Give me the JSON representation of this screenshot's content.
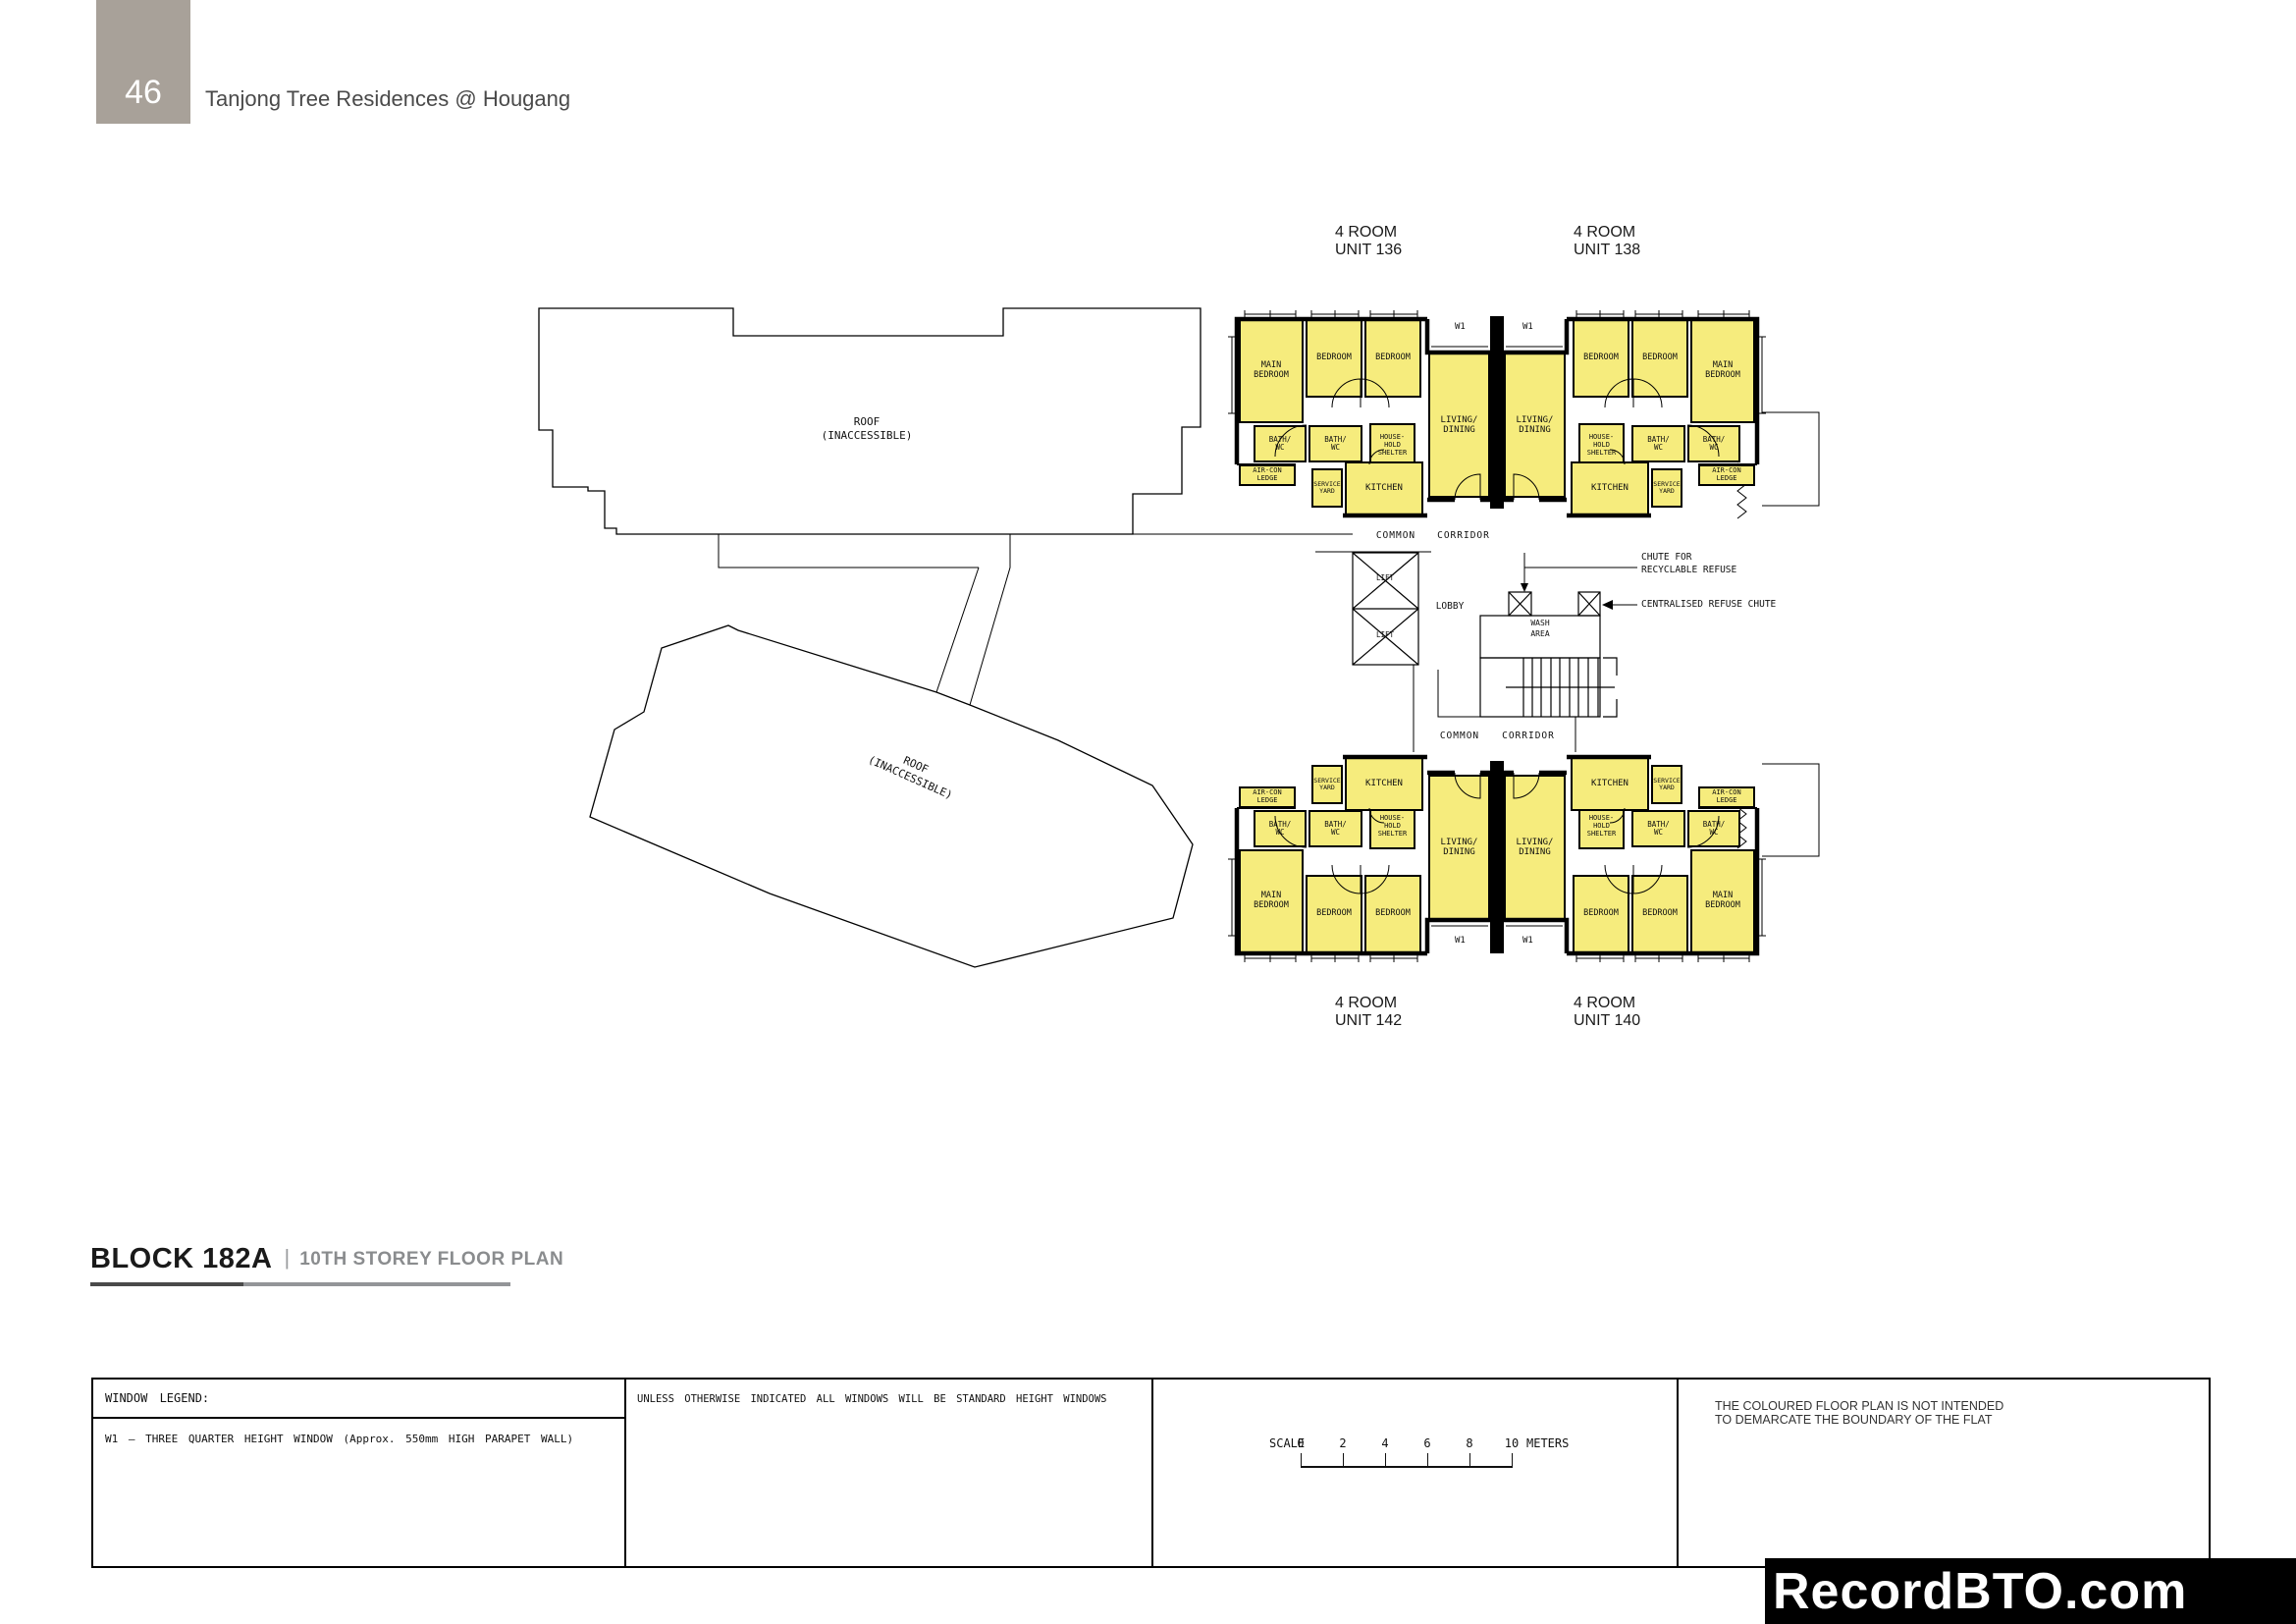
{
  "page": {
    "number": "46",
    "title": "Tanjong Tree Residences @ Hougang"
  },
  "plan": {
    "unit_labels": [
      {
        "line1": "4 ROOM",
        "line2": "UNIT 136"
      },
      {
        "line1": "4 ROOM",
        "line2": "UNIT 138"
      },
      {
        "line1": "4 ROOM",
        "line2": "UNIT 142"
      },
      {
        "line1": "4 ROOM",
        "line2": "UNIT 140"
      }
    ],
    "rooms": {
      "main_bedroom": [
        "MAIN",
        "BEDROOM"
      ],
      "bedroom": [
        "BEDROOM"
      ],
      "living": [
        "LIVING/",
        "DINING"
      ],
      "bath": [
        "BATH/",
        "WC"
      ],
      "shelter": [
        "HOUSE-",
        "HOLD",
        "SHELTER"
      ],
      "aircon": [
        "AIR-CON",
        "LEDGE"
      ],
      "service": [
        "SERVICE",
        "YARD"
      ],
      "kitchen": [
        "KITCHEN"
      ]
    },
    "roof_label": [
      "ROOF",
      "(INACCESSIBLE)"
    ],
    "corridor_words": [
      "COMMON",
      "CORRIDOR"
    ],
    "core": {
      "lift": "LIFT",
      "lobby": "LOBBY",
      "wash": [
        "WASH",
        "AREA"
      ]
    },
    "annotations": {
      "recyclable": [
        "CHUTE FOR",
        "RECYCLABLE REFUSE"
      ],
      "central": "CENTRALISED REFUSE CHUTE"
    },
    "window_tag": "W1"
  },
  "footer": {
    "block": "BLOCK 182A",
    "sep": "|",
    "storey": "10TH STOREY FLOOR PLAN"
  },
  "legend": {
    "title": "WINDOW LEGEND:",
    "w1": "W1  –  THREE QUARTER HEIGHT WINDOW  (Approx. 550mm HIGH PARAPET WALL)",
    "note": "UNLESS OTHERWISE INDICATED ALL WINDOWS WILL BE STANDARD HEIGHT WINDOWS",
    "scale": {
      "label": "SCALE",
      "ticks": [
        "0",
        "2",
        "4",
        "6",
        "8",
        "10"
      ],
      "unit": "METERS"
    },
    "disclaimer": [
      "THE COLOURED FLOOR PLAN IS NOT INTENDED",
      "TO DEMARCATE THE BOUNDARY OF THE FLAT"
    ]
  },
  "watermark": "RecordBTO.com",
  "colors": {
    "room_fill": "#F6EC7D",
    "wall": "#000000",
    "page_tab": "#A8A199",
    "muted": "#8A8C8E",
    "banner_bg": "#000000",
    "banner_fg": "#FFFFFF"
  }
}
